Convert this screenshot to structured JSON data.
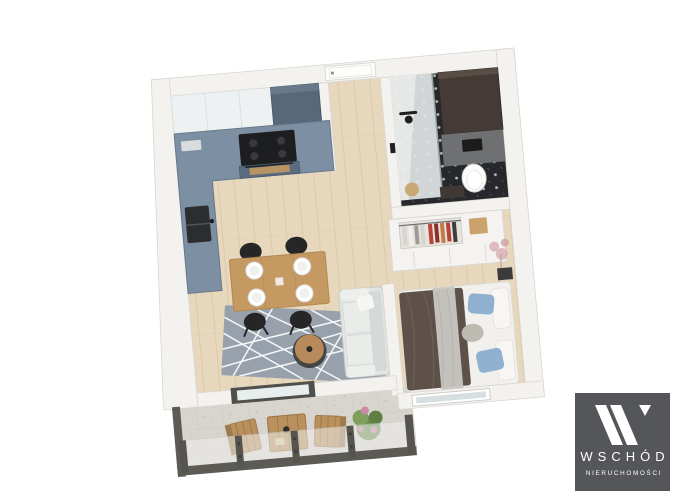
{
  "watermark": {
    "brand": "WSCHÓD",
    "tagline": "NIERUCHOMOŚCI"
  },
  "palette": {
    "background": "#ffffff",
    "wall": "#f3f2ef",
    "wall_edge": "#d9d6d1",
    "wood_floor": "#e7d7bc",
    "kitchen_cabinet": "#7d8fa2",
    "kitchen_tall_unit": "#56687a",
    "kitchen_upper_cabinet": "#eef1f2",
    "cooktop": "#1d1e20",
    "oven_front": "#5a6c7e",
    "oven_window": "#c99a5f",
    "sink": "#2b2d2f",
    "entry_door": "#fdfdfc",
    "dining_table": "#c59a62",
    "stool": "#262626",
    "plate": "#ffffff",
    "rug": "#98a1ab",
    "rug_line": "#ffffff",
    "coffee_table": "#b8895a",
    "sofa": "#e2e5e3",
    "bed_linen": "#f2f0ed",
    "bed_duvet": "#5e5149",
    "bed_throw": "#c8c6c1",
    "bed_pillow_blue": "#8fb0cf",
    "bed_pillow_gray": "#bdbab2",
    "wardrobe": "#f4f3f1",
    "wardrobe_box": "#c9a36b",
    "bathroom_floor": "#26282c",
    "bathroom_cabinet": "#453b36",
    "bathroom_wall_panel": "#6e7072",
    "toilet": "#fbfbfa",
    "shower_glass": "#dfe4e5",
    "balcony_floor": "#d8d5cf",
    "railing": "#5b5a55",
    "outdoor_wood": "#b9905e",
    "plant_green": "#6b8d4d",
    "plant_flower": "#c98ba6",
    "logo_background": "#55565a",
    "logo_foreground": "#ffffff"
  }
}
